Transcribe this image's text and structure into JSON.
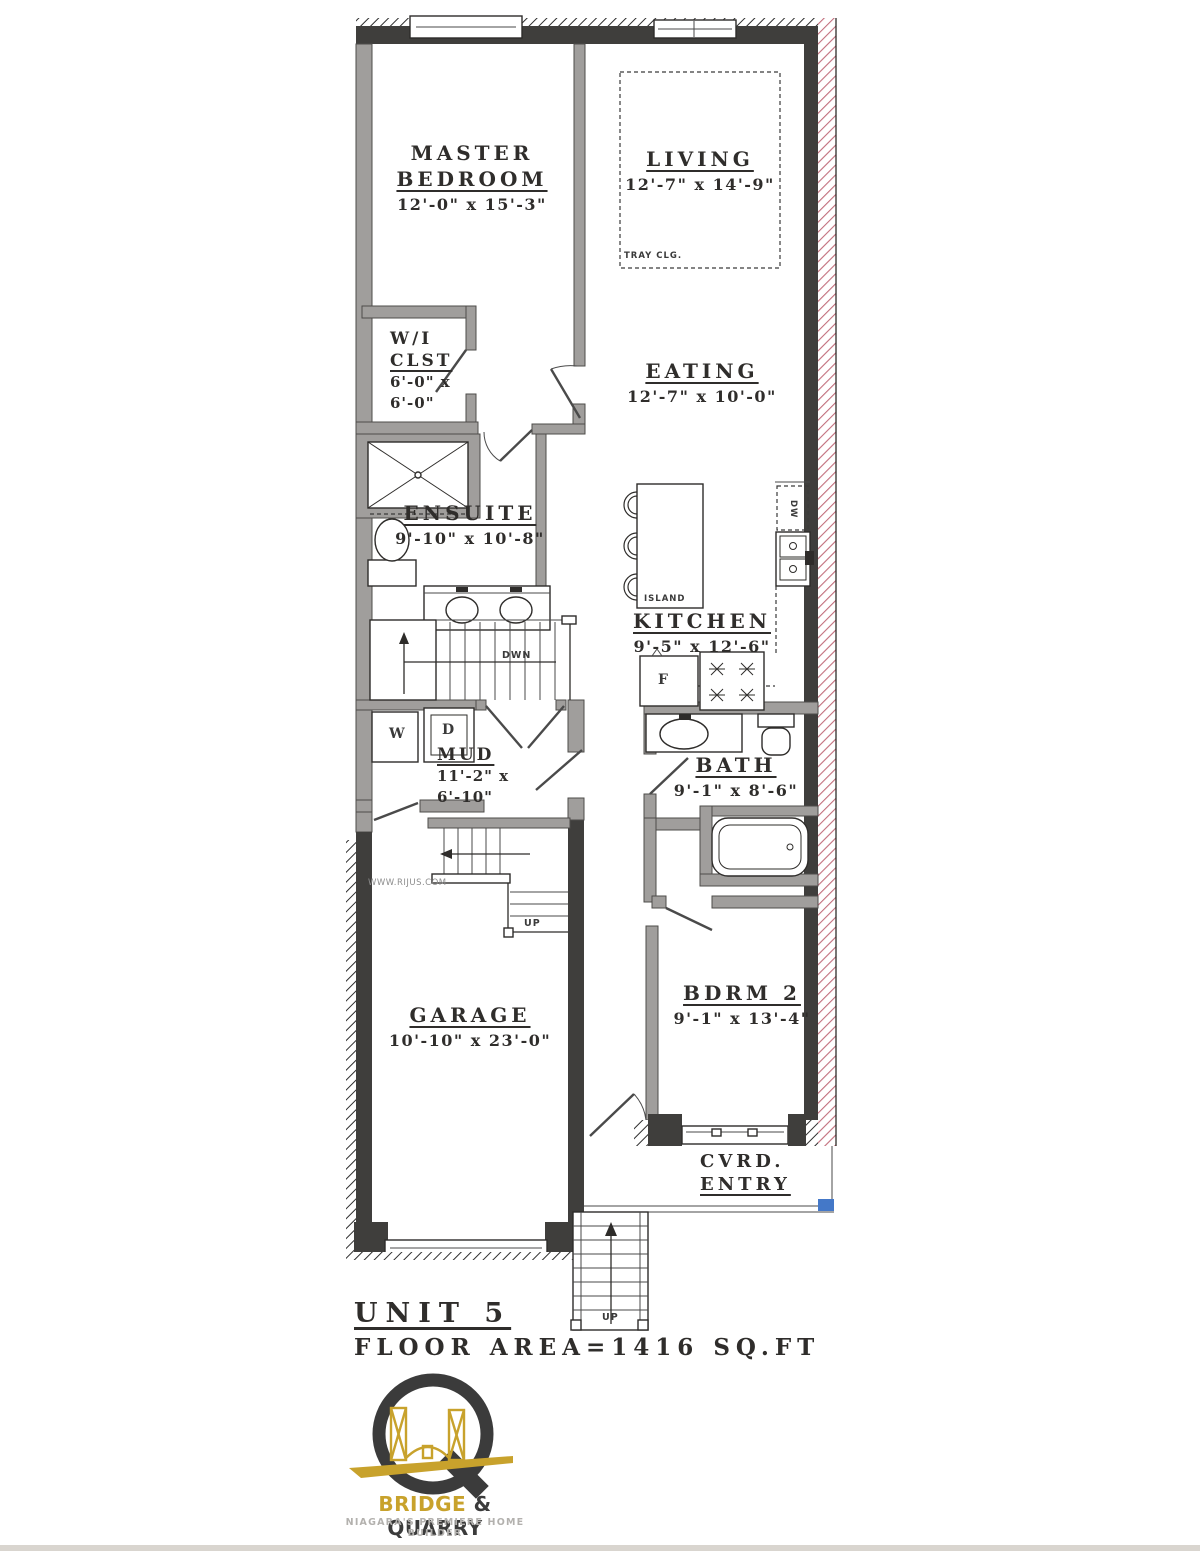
{
  "plan": {
    "rooms": {
      "master_bedroom": {
        "name1": "MASTER",
        "name2": "BEDROOM",
        "dims": "12'-0\" x 15'-3\""
      },
      "living": {
        "name": "LIVING",
        "dims": "12'-7\" x 14'-9\""
      },
      "wi_clst": {
        "name1": "W/I",
        "name2": "CLST",
        "dims1": "6'-0\" x",
        "dims2": "6'-0\""
      },
      "eating": {
        "name": "EATING",
        "dims": "12'-7\" x 10'-0\""
      },
      "ensuite": {
        "name": "ENSUITE",
        "dims": "9'-10\" x 10'-8\""
      },
      "kitchen": {
        "name": "KITCHEN",
        "dims": "9'-5\" x 12'-6\""
      },
      "mud": {
        "name": "MUD",
        "dims1": "11'-2\" x",
        "dims2": "6'-10\""
      },
      "bath": {
        "name": "BATH",
        "dims": "9'-1\" x 8'-6\""
      },
      "garage": {
        "name": "GARAGE",
        "dims": "10'-10\" x 23'-0\""
      },
      "bdrm2": {
        "name": "BDRM 2",
        "dims": "9'-1\" x 13'-4\""
      },
      "cvrd_entry": {
        "name1": "CVRD.",
        "name2": "ENTRY"
      }
    },
    "annotations": {
      "tray_clg": "TRAY CLG.",
      "island": "ISLAND",
      "dwn": "DWN",
      "up_stair": "UP",
      "up_porch": "UP",
      "washer": "W",
      "dryer": "D",
      "fridge": "F",
      "dishwasher": "DW",
      "watermark": "WWW.RIJUS.COM"
    },
    "title": {
      "unit": "UNIT 5",
      "floor_area": "FLOOR AREA=1416 SQ.FT"
    }
  },
  "logo": {
    "bridge": "BRIDGE",
    "amp": " & ",
    "quarry": "QUARRY",
    "tagline": "NIAGARA'S PREMIERE HOME BUILDER"
  },
  "colors": {
    "wall_dark": "#3f3e3c",
    "wall_gray": "#a09e9c",
    "party_hatch": "#c26e7c",
    "porch_marker_blue": "#4478c8",
    "label_ink": "#2f2d2b",
    "watermark": "#8d8d8d",
    "logo_gold": "#c8a22c",
    "logo_dark": "#3b3b3b",
    "logo_gray": "#b3b1ae",
    "scan_strip": "#d9d5cf"
  }
}
